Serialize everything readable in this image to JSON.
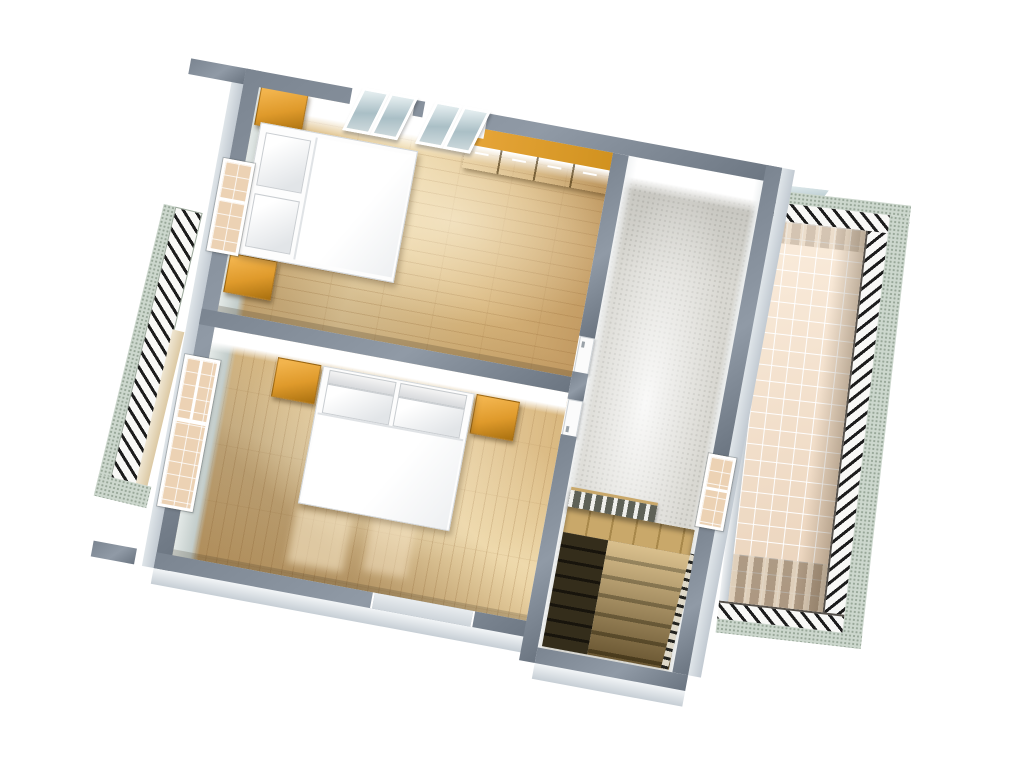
{
  "scene": {
    "title": "Upper floor 3D floor plan render",
    "view": "aerial cut-away 3D view, plan rotated clockwise",
    "background": "#ffffff",
    "text_content": "none — image contains no readable text"
  },
  "rooms": [
    {
      "id": "bedroom-1",
      "position": "top-left",
      "floor": "wood parquet, planks horizontal",
      "furniture": [
        "double bed with white duvet and two pillows",
        "nightstand (orange) above bed head",
        "nightstand (orange) below bed head",
        "orange sideboard with 4 doors along top wall"
      ],
      "openings": [
        "window in left wall",
        "two pairs of roof windows in top wall",
        "door to hallway"
      ]
    },
    {
      "id": "bedroom-2",
      "position": "bottom-left",
      "floor": "wood parquet, planks vertical",
      "furniture": [
        "double bed with white duvet, two pillows and headboard panels",
        "nightstand (orange) left of bed head",
        "nightstand (orange) right of bed head"
      ],
      "openings": [
        "tall window in left wall",
        "door to hallway",
        "small opening in bottom wall"
      ]
    },
    {
      "id": "hallway",
      "position": "right of bedrooms",
      "floor": "gray speckled carpet",
      "features": [
        "staircase going down",
        "balustrade with white balusters",
        "stair railing",
        "dark stair opening",
        "glass door to terrace"
      ]
    },
    {
      "id": "terrace",
      "position": "far right outside",
      "floor": "beige square tiles",
      "features": [
        "hatched railing band on three sides",
        "speckled outer curb",
        "railing shadow with light slots on tiles",
        "small roof window at top edge"
      ]
    },
    {
      "id": "balcony-railing-strip",
      "position": "far left outside",
      "features": [
        "hatched railing",
        "speckled curb",
        "end cap"
      ]
    }
  ],
  "counts": {
    "bedrooms": 2,
    "beds": 2,
    "nightstands": 4,
    "sideboards": 1,
    "roof_window_panes": 4,
    "staircases": 1
  },
  "colors": {
    "wall_top": "#7b8591",
    "wall_top_light": "#909aa6",
    "wall_top_dark": "#6b7581",
    "wall_face": "#f2f5f7",
    "parquet_light": "#eed9ac",
    "parquet_mid": "#d9b77e",
    "parquet_dark": "#c29a62",
    "carpet": "#d9d8d2",
    "tile": "#f4e1cd",
    "furniture_orange_light": "#f2b44d",
    "furniture_orange": "#df9a2b",
    "furniture_orange_dark": "#a9700f",
    "stair_wood": "#c9a86a",
    "stair_hole": "#342d1b",
    "railing_speckle": "#ccd7cd",
    "hatch_dark": "#1c1c1c",
    "skylight_glass": "#aabfc6",
    "window_glass": "#ecd2b4"
  }
}
